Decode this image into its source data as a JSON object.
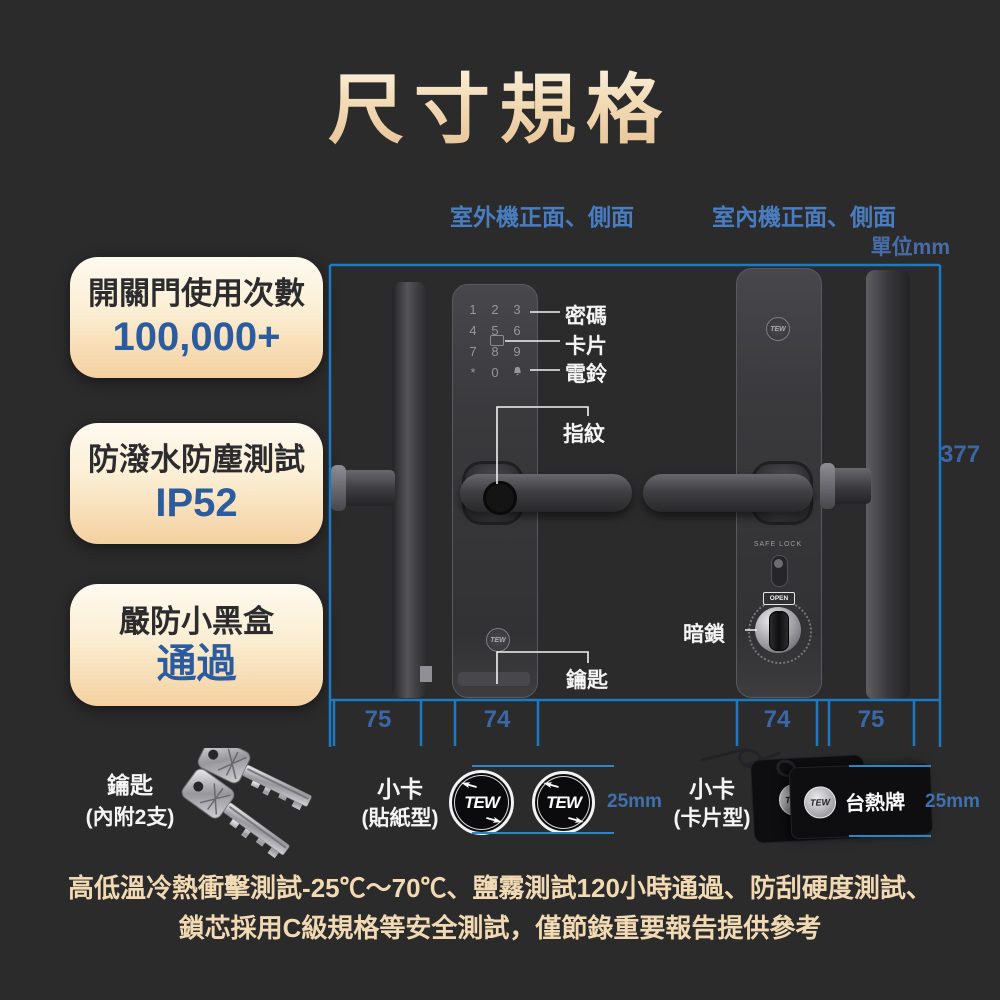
{
  "title": "尺寸規格",
  "unit_label": "單位mm",
  "view_labels": {
    "outdoor": "室外機正面、側面",
    "indoor": "室內機正面、側面"
  },
  "feature_boxes": [
    {
      "line1": "開關門使用次數",
      "line2": "100,000+"
    },
    {
      "line1": "防潑水防塵測試",
      "line2": "IP52"
    },
    {
      "line1": "嚴防小黑盒",
      "line2": "通過"
    }
  ],
  "callouts": {
    "password": "密碼",
    "card": "卡片",
    "doorbell": "電鈴",
    "fingerprint": "指紋",
    "key": "鑰匙",
    "deadbolt": "暗鎖"
  },
  "dimensions": {
    "outdoor_side_width": "75",
    "outdoor_front_width": "74",
    "indoor_front_width": "74",
    "indoor_side_width": "75",
    "height": "377",
    "sticker_size": "25mm",
    "card_size": "25mm"
  },
  "outdoor_unit": {
    "keypad": [
      "1",
      "2",
      "3",
      "4",
      "5",
      "6",
      "7",
      "8",
      "9",
      "*",
      "0"
    ],
    "logo": "TEW"
  },
  "indoor_unit": {
    "safe_lock_label": "SAFE LOCK",
    "open_label": "OPEN",
    "logo": "TEW"
  },
  "accessories": {
    "keys": {
      "title": "鑰匙",
      "subtitle": "(內附2支)"
    },
    "stickers": {
      "title": "小卡",
      "subtitle": "(貼紙型)",
      "logo": "TEW"
    },
    "cards": {
      "title": "小卡",
      "subtitle": "(卡片型)",
      "logo": "TEW",
      "brand": "台熱牌"
    }
  },
  "footnote": {
    "line1": "高低溫冷熱衝擊測試-25℃～70℃、鹽霧測試120小時通過、防刮硬度測試、",
    "line2": "鎖芯採用C級規格等安全測試，僅節錄重要報告提供參考"
  },
  "colors": {
    "accent_blue": "#4a7cc0",
    "dimension_line": "#1d7ac2",
    "cream": "#f5d2a0",
    "navy": "#2b5c9f",
    "background": "#2b2b2b"
  }
}
